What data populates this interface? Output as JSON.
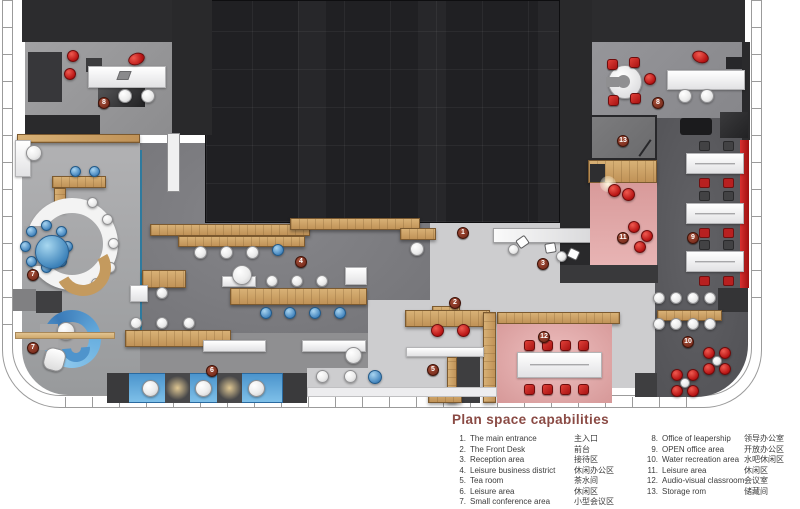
{
  "plan": {
    "markers": [
      "1",
      "2",
      "3",
      "4",
      "5",
      "6",
      "7",
      "7",
      "8",
      "8",
      "9",
      "10",
      "11",
      "12",
      "13"
    ]
  },
  "legend": {
    "title": "Plan space capabilities",
    "left": [
      {
        "num": "1.",
        "en": "The main entrance",
        "zh": "主入口"
      },
      {
        "num": "2.",
        "en": "The Front Desk",
        "zh": "前台"
      },
      {
        "num": "3.",
        "en": "Reception area",
        "zh": "接待区"
      },
      {
        "num": "4.",
        "en": "Leisure business district",
        "zh": "休闲办公区"
      },
      {
        "num": "5.",
        "en": "Tea room",
        "zh": "茶水间"
      },
      {
        "num": "6.",
        "en": "Leisure area",
        "zh": "休闲区"
      },
      {
        "num": "7.",
        "en": "Small conference area",
        "zh": "小型会议区"
      }
    ],
    "right": [
      {
        "num": "8.",
        "en": "Office of leapership",
        "zh": "领导办公室"
      },
      {
        "num": "9.",
        "en": "OPEN office area",
        "zh": "开放办公区"
      },
      {
        "num": "10.",
        "en": "Water recreation area",
        "zh": "水吧休闲区"
      },
      {
        "num": "11.",
        "en": "Leisure  area",
        "zh": "休闲区"
      },
      {
        "num": "12.",
        "en": "Audio-visual classroom",
        "zh": "会议室"
      },
      {
        "num": "13.",
        "en": "Storage rom",
        "zh": "储藏间"
      }
    ]
  },
  "colors": {
    "wood": "#c89c5c",
    "blue_accent": "#4a90c8",
    "pink_room": "#e0a4a4",
    "red_chair": "#c01818",
    "marker": "#6e2315",
    "legend_title": "#8a4a44",
    "core_dark": "#202023"
  }
}
